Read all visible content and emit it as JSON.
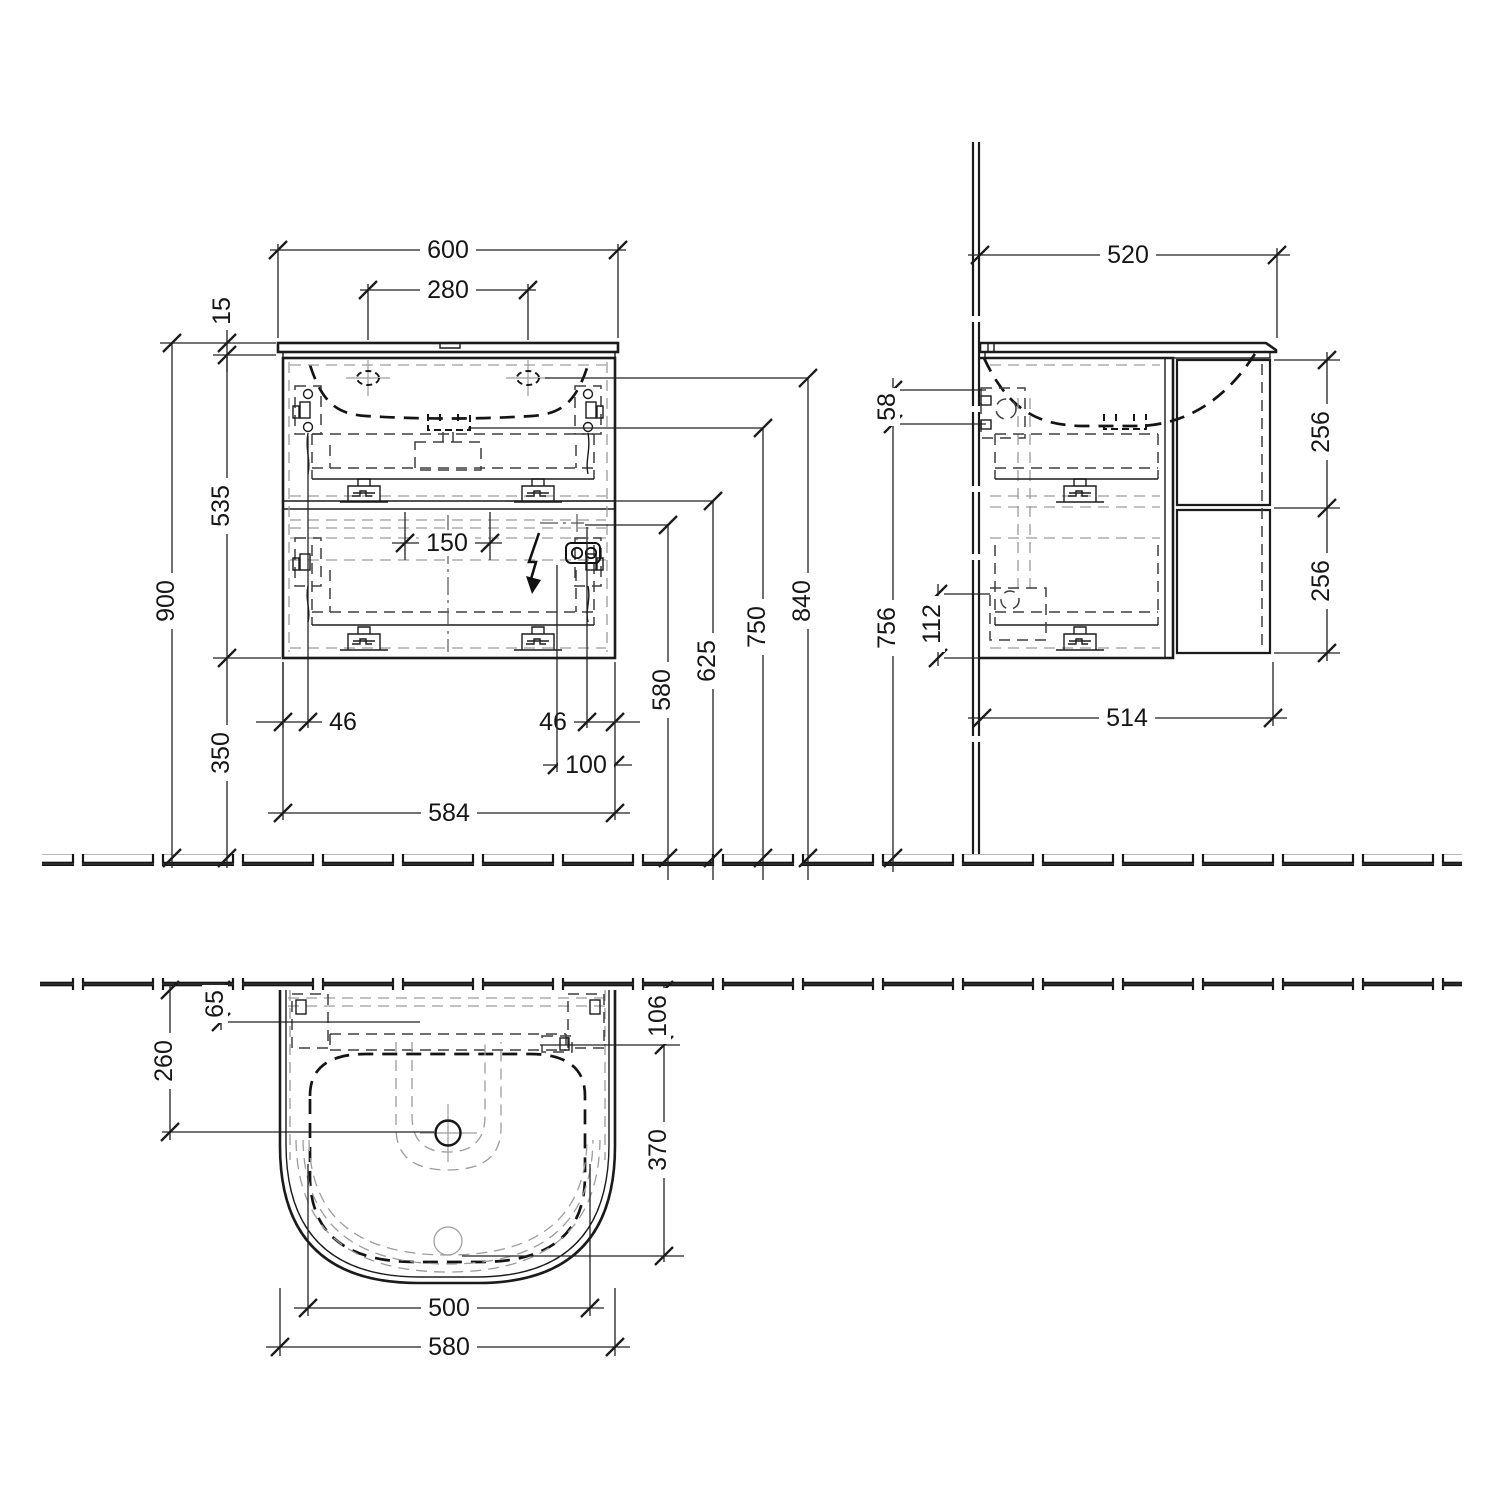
{
  "views": {
    "front": {
      "dims": {
        "overall_width": "600",
        "tap_spacing": "280",
        "countertop_thickness": "15",
        "cabinet_height": "535",
        "mounting_height": "900",
        "floor_clearance": "350",
        "trap_cutout_width": "150",
        "fixing_offset_left": "46",
        "fixing_offset_right": "46",
        "socket_offset": "100",
        "cabinet_width": "584",
        "outlet_height": "580",
        "drawer_split_height": "625",
        "drain_height": "750",
        "basin_rim_height": "840"
      }
    },
    "side": {
      "dims": {
        "overall_depth": "520",
        "fixing_bracket_height": "58",
        "trap_height": "756",
        "outlet_clearance": "112",
        "upper_drawer_front": "256",
        "lower_drawer_front": "256",
        "body_depth": "514"
      }
    },
    "plan": {
      "dims": {
        "rear_offset": "65",
        "rear_clearance": "106",
        "tap_from_wall": "260",
        "bowl_depth": "370",
        "bowl_width": "500",
        "basin_width": "580"
      }
    }
  }
}
